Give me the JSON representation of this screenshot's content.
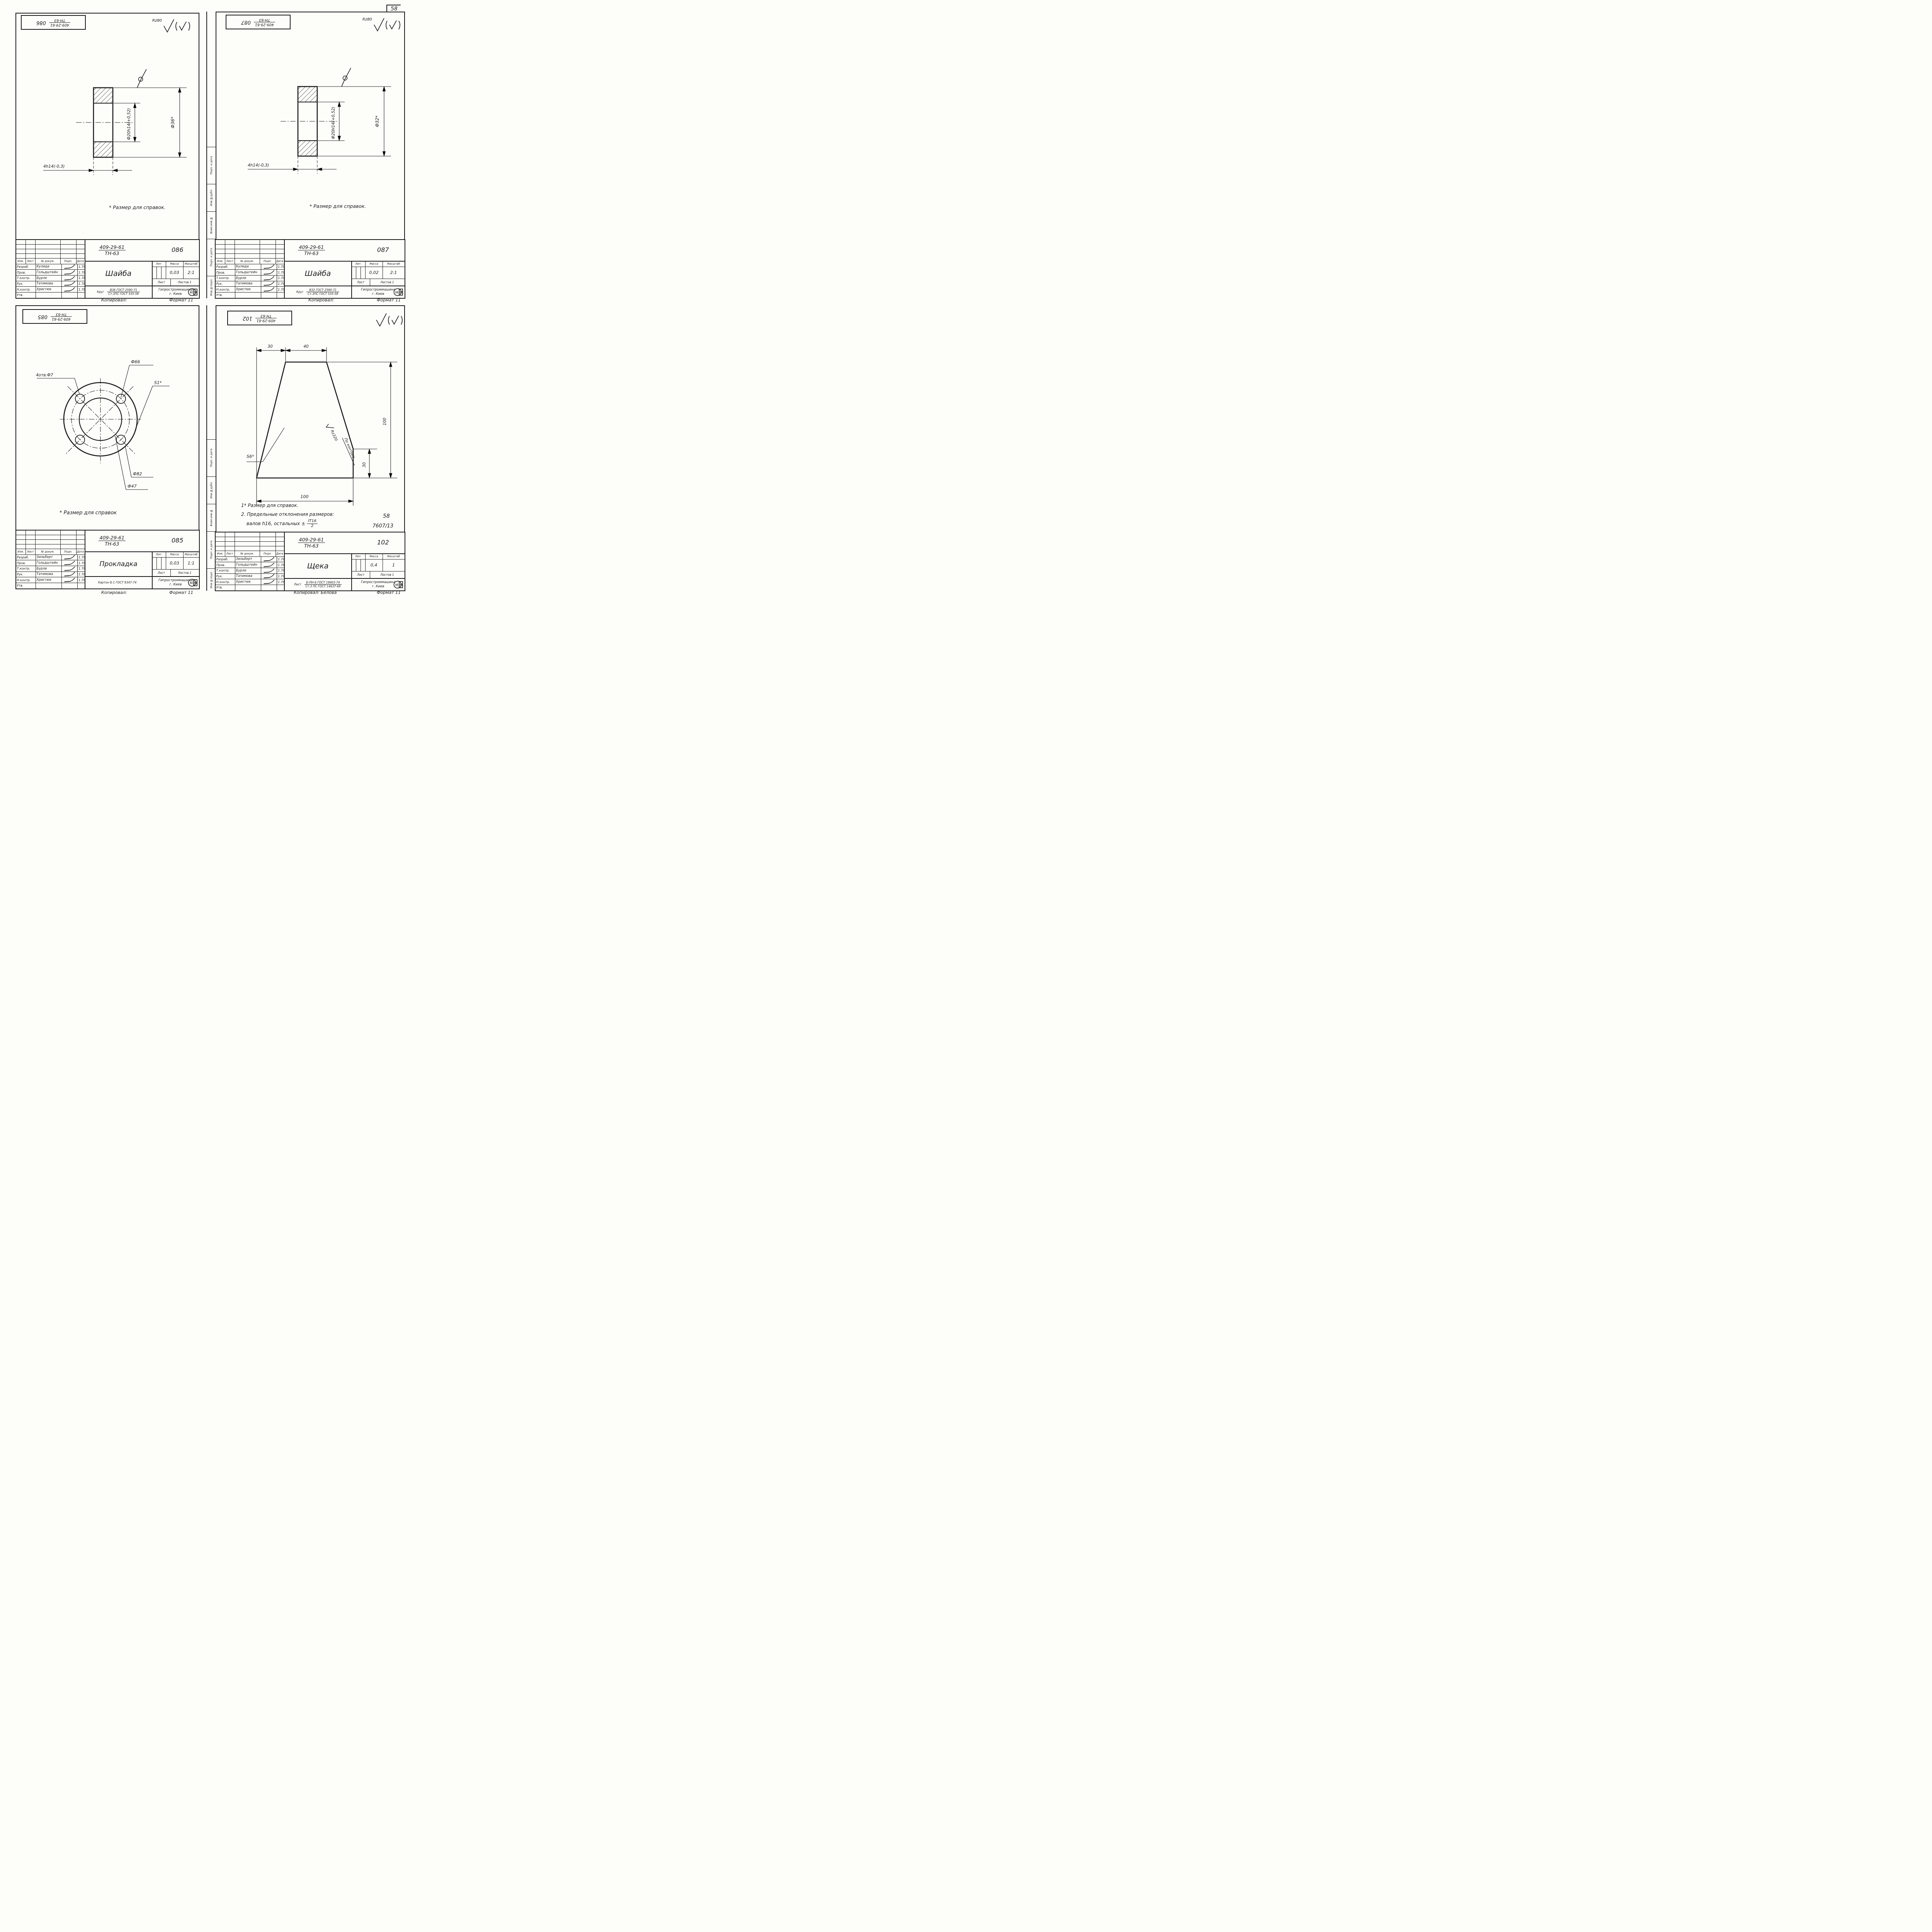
{
  "page": {
    "number": "58",
    "side_strip": [
      "Подп. и дата",
      "Инв.№дубл.",
      "Взам.инв.№",
      "Подп. и дата",
      "Инв.№подл."
    ],
    "footers": {
      "mid_left": "Копировал:",
      "mid_left_format": "Формат 11",
      "mid_right": "Копировал:",
      "mid_right_format": "Формат 11",
      "bottom_left": "Копировал:",
      "bottom_left_format": "Формат 11",
      "bottom_right": "Копировал: Белова",
      "bottom_right_format": "Формат 11"
    }
  },
  "labels": {
    "izm": "Изм.",
    "list": "Лист",
    "dokum": "№ докум.",
    "podp": "Подп.",
    "data": "Дата",
    "lit": "Лит.",
    "massa": "Масса",
    "masshtab": "Масштаб",
    "list2": "Лист",
    "listov": "Листов 1"
  },
  "sheets": [
    {
      "num": "086",
      "code_top": "409-29-61",
      "code_bottom": "ТН-63",
      "title": "Шайба",
      "roughness": "Rz80",
      "rows": [
        {
          "role": "Разраб.",
          "name": "Кулида",
          "date": "11.78"
        },
        {
          "role": "Пров.",
          "name": "Гольдштейн",
          "date": "11.78"
        },
        {
          "role": "Т.контр.",
          "name": "Бурле",
          "date": "11.78"
        },
        {
          "role": "Рук.",
          "name": "Татимова",
          "date": "11.78"
        },
        {
          "role": "Н.контр.",
          "name": "Христюк",
          "date": "11.78"
        },
        {
          "role": "Утв.",
          "name": "",
          "date": ""
        }
      ],
      "massa": "0,03",
      "masshtab": "2:1",
      "material_prefix": "Круг",
      "material_single": "",
      "material_top": "В36 ГОСТ 2590-71",
      "material_bottom": "Ст.3ПС ГОСТ 535-58",
      "org": "Гипростроммашина",
      "city": "г. Киев",
      "note": "* Размер для справок.",
      "dims": {
        "inner": "Ф20h14(+0,52)",
        "outer": "Ф36*",
        "thick": "4h14(-0,3)"
      }
    },
    {
      "num": "087",
      "code_top": "409-29-61",
      "code_bottom": "ТН-63",
      "title": "Шайба",
      "roughness": "Rz80",
      "rows": [
        {
          "role": "Разраб.",
          "name": "Кулида",
          "date": "11.78"
        },
        {
          "role": "Пров.",
          "name": "Гольдштейн",
          "date": "11.78"
        },
        {
          "role": "Т.контр.",
          "name": "Бурле",
          "date": "11.78"
        },
        {
          "role": "Рук.",
          "name": "Татимова",
          "date": "11.78"
        },
        {
          "role": "Н.контр.",
          "name": "Христюк",
          "date": "11.78"
        },
        {
          "role": "Утв.",
          "name": "",
          "date": ""
        }
      ],
      "massa": "0,02",
      "masshtab": "2:1",
      "material_prefix": "Круг",
      "material_single": "",
      "material_top": "В32 ГОСТ 2590-71",
      "material_bottom": "Ст.3ПС ГОСТ 535-58",
      "org": "Гипростроммашина",
      "city": "г. Киев",
      "note": "* Размер для справок.",
      "dims": {
        "inner": "Ф20H14(+0,52)",
        "outer": "Ф32*",
        "thick": "4h14(-0,3)"
      }
    },
    {
      "num": "085",
      "code_top": "409-29-61",
      "code_bottom": "ТН-63",
      "title": "Прокладка",
      "roughness": "",
      "rows": [
        {
          "role": "Разраб.",
          "name": "Зильберт",
          "date": "11.78"
        },
        {
          "role": "Пров.",
          "name": "Гольдштейн",
          "date": "11.78"
        },
        {
          "role": "Т.контр.",
          "name": "Бурле",
          "date": "11.78"
        },
        {
          "role": "Рук.",
          "name": "Татимова",
          "date": "11.78"
        },
        {
          "role": "Н.контр.",
          "name": "Христюк",
          "date": "11.78"
        },
        {
          "role": "Утв.",
          "name": "",
          "date": ""
        }
      ],
      "massa": "0,03",
      "masshtab": "1:1",
      "material_prefix": "",
      "material_single": "Картон Б-1 ГОСТ 9347-74",
      "material_top": "",
      "material_bottom": "",
      "org": "Гипростроммашина",
      "city": "г. Киев",
      "note": "* Размер для справок",
      "dims": {
        "holes": "4отв.Ф7",
        "d66": "Ф66",
        "s": "S1*",
        "d82": "Ф82",
        "d47": "Ф47"
      }
    },
    {
      "num": "102",
      "code_top": "409-29-61",
      "code_bottom": "ТН-63",
      "title": "Щека",
      "roughness": "",
      "rows": [
        {
          "role": "Разраб.",
          "name": "Зильберт",
          "date": "11.78"
        },
        {
          "role": "Пров.",
          "name": "Гольдштейн",
          "date": "11.78"
        },
        {
          "role": "Т.контр.",
          "name": "Бурле",
          "date": "11.78"
        },
        {
          "role": "Рук.",
          "name": "Татимова",
          "date": "11.78"
        },
        {
          "role": "Н.контр.",
          "name": "Христюк",
          "date": "11.78"
        },
        {
          "role": "Утв.",
          "name": "",
          "date": ""
        }
      ],
      "massa": "0,4",
      "masshtab": "1",
      "material_prefix": "Лист",
      "material_single": "",
      "material_top": "Б-ПН-6 ГОСТ 19903-74",
      "material_bottom": "Ст.3 ПС ГОСТ 14637-69",
      "org": "Гипростроммашина",
      "city": "г. Киев",
      "note1": "1* Размер для справок.",
      "note2": "2. Предельные отклонения размеров:",
      "note3": "валов h16, остальных ±",
      "tol_top": "IT16",
      "tol_bottom": "2",
      "extra_num": "58",
      "extra_code": "7607/13",
      "dims": {
        "t30": "30",
        "t40": "40",
        "b100": "100",
        "r100": "100",
        "r30": "30",
        "rz": "Rz320",
        "contour": "По контуру",
        "s": "S6*"
      }
    }
  ]
}
